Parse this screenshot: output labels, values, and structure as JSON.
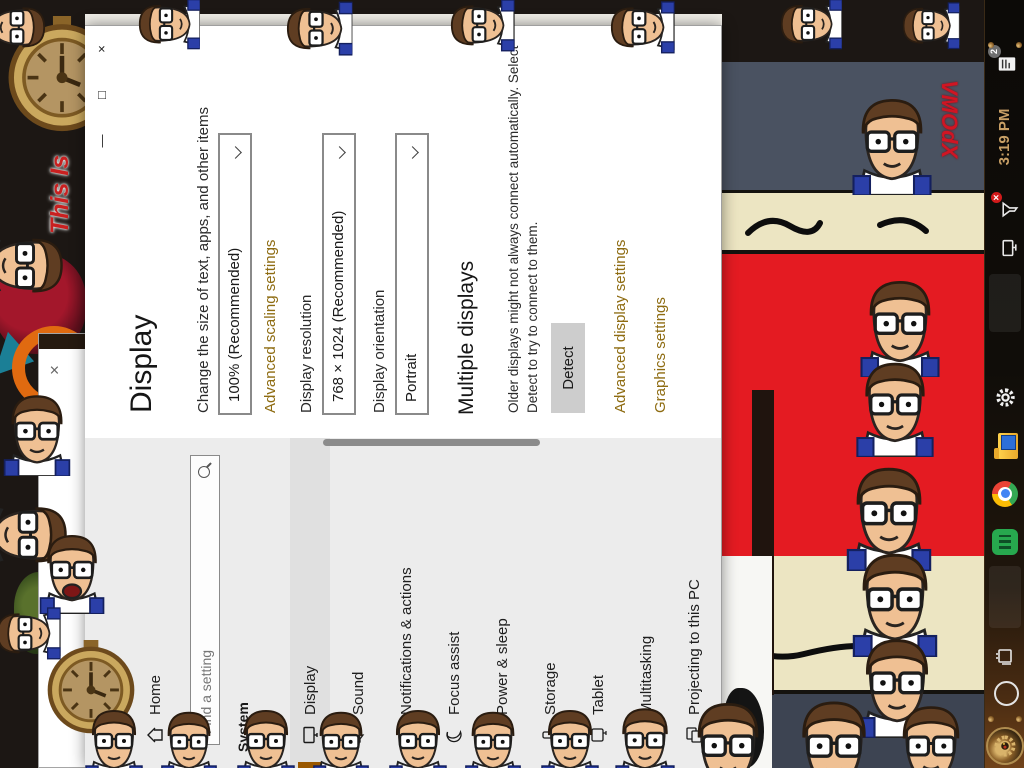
{
  "wallpaper": {
    "left_text": "This Is",
    "right_text": "VMOdX"
  },
  "background_window": {
    "close": "×"
  },
  "settings": {
    "titlebar": {
      "back": "←",
      "title": "Settings",
      "minimize": "—",
      "maximize": "□",
      "close": "×"
    },
    "nav": {
      "home": "Home",
      "search_placeholder": "Find a setting",
      "section_header": "System",
      "items": [
        {
          "label": "Display",
          "icon": "display-icon",
          "selected": true
        },
        {
          "label": "Sound",
          "icon": "sound-icon",
          "selected": false
        },
        {
          "label": "Notifications & actions",
          "icon": "notifications-icon",
          "selected": false
        },
        {
          "label": "Focus assist",
          "icon": "focus-assist-icon",
          "selected": false
        },
        {
          "label": "Power & sleep",
          "icon": "power-icon",
          "selected": false
        },
        {
          "label": "Storage",
          "icon": "storage-icon",
          "selected": false
        },
        {
          "label": "Tablet",
          "icon": "tablet-icon",
          "selected": false
        },
        {
          "label": "Multitasking",
          "icon": "multitasking-icon",
          "selected": false
        },
        {
          "label": "Projecting to this PC",
          "icon": "projecting-icon",
          "selected": false
        }
      ]
    },
    "page": {
      "title": "Display",
      "scale_subtitle": "Change the size of text, apps, and other items",
      "scale_value": "100% (Recommended)",
      "advanced_scaling_link": "Advanced scaling settings",
      "resolution_label": "Display resolution",
      "resolution_value": "768 × 1024 (Recommended)",
      "orientation_label": "Display orientation",
      "orientation_value": "Portrait",
      "multiple_heading": "Multiple displays",
      "multiple_line1": "Older displays might not always connect automatically. Select",
      "multiple_line2": "Detect to try to connect to them.",
      "detect_button": "Detect",
      "advanced_display_link": "Advanced display settings",
      "graphics_link": "Graphics settings"
    }
  },
  "taskbar": {
    "clock": "3:19 PM",
    "notification_badge": "2"
  },
  "colors": {
    "accent_link": "#8e6c12",
    "nav_selected_accent": "#9a5800",
    "band_red": "#e41b22",
    "band_slate": "#4a5261",
    "band_beige": "#ece5c2",
    "taskbar_clock": "#c9a066"
  }
}
